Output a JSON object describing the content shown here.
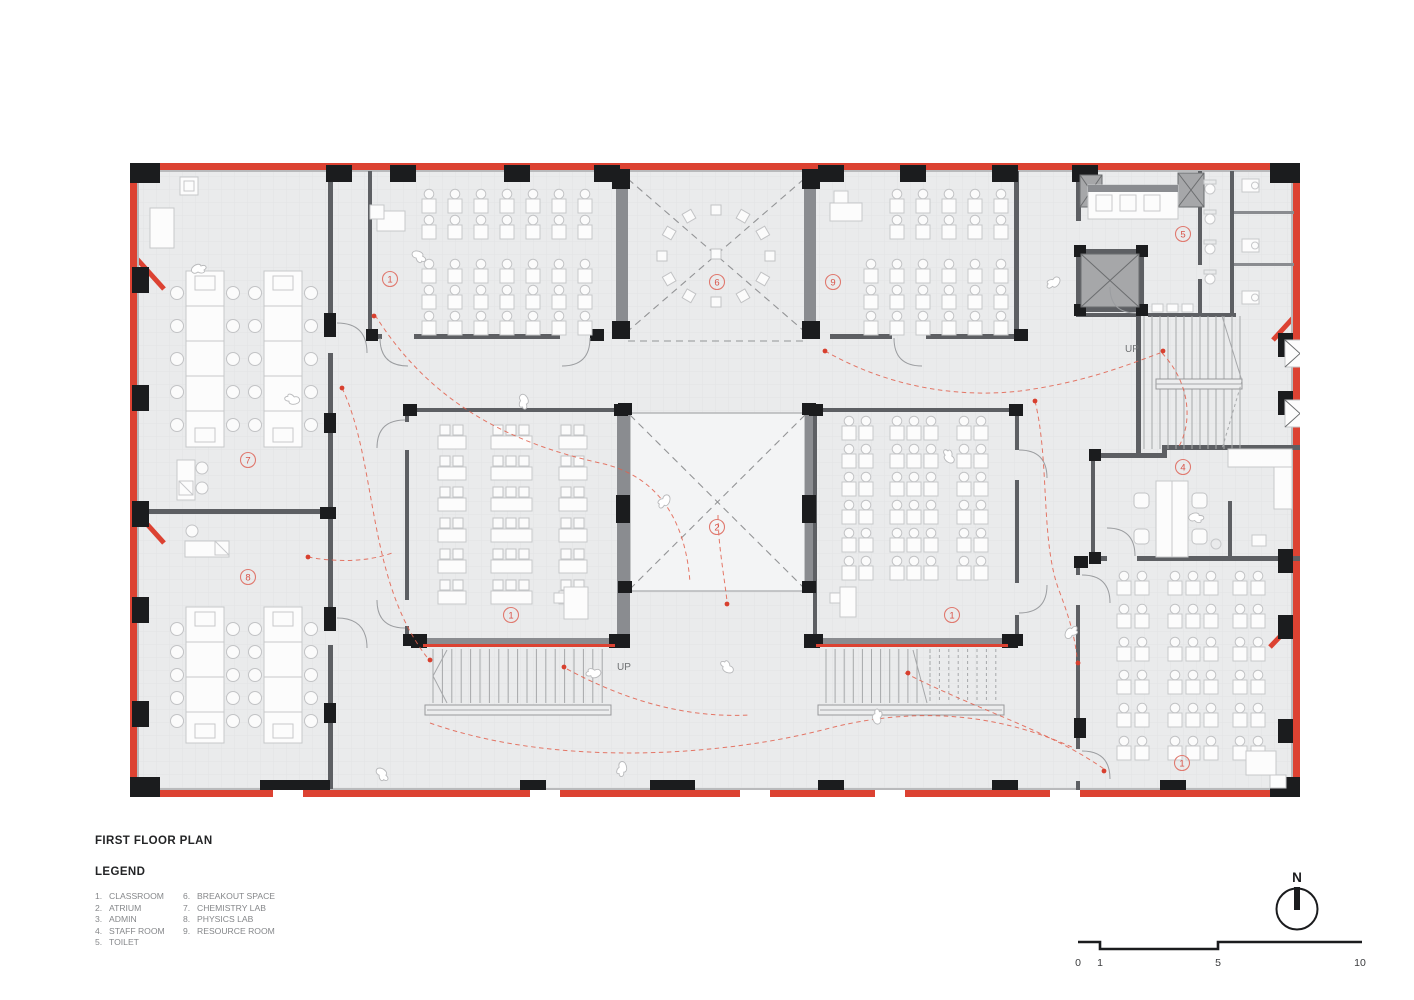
{
  "title": "FIRST FLOOR PLAN",
  "legend": {
    "heading": "LEGEND",
    "items": [
      {
        "num": "1.",
        "label": "CLASSROOM"
      },
      {
        "num": "2.",
        "label": "ATRIUM"
      },
      {
        "num": "3.",
        "label": "ADMIN"
      },
      {
        "num": "4.",
        "label": "STAFF ROOM"
      },
      {
        "num": "5.",
        "label": "TOILET"
      },
      {
        "num": "6.",
        "label": "BREAKOUT SPACE"
      },
      {
        "num": "7.",
        "label": "CHEMISTRY LAB"
      },
      {
        "num": "8.",
        "label": "PHYSICS LAB"
      },
      {
        "num": "9.",
        "label": "RESOURCE ROOM"
      }
    ]
  },
  "plan": {
    "up_label": "UP",
    "markers": [
      {
        "num": "7"
      },
      {
        "num": "8"
      },
      {
        "num": "1"
      },
      {
        "num": "6"
      },
      {
        "num": "9"
      },
      {
        "num": "5"
      },
      {
        "num": "1"
      },
      {
        "num": "2"
      },
      {
        "num": "1"
      },
      {
        "num": "4"
      },
      {
        "num": "1"
      }
    ]
  },
  "north": {
    "label": "N"
  },
  "scale": {
    "labels": [
      "0",
      "1",
      "5",
      "10"
    ]
  },
  "colors": {
    "exterior_wall": "#dc4232",
    "circulation": "#e2604e",
    "floor": "#eaebec",
    "wall": "#5d5f63"
  }
}
